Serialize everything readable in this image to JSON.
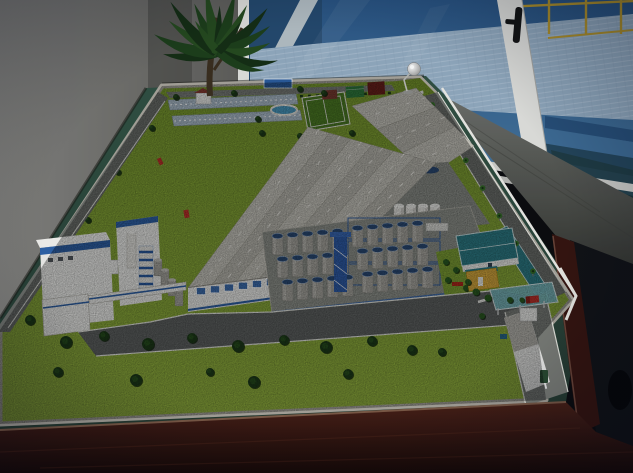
{
  "meta": {
    "kind": "photograph",
    "subject": "architectural scale model of an industrial plant displayed on a dark wooden table beside glass doors",
    "width": 633,
    "height": 473
  },
  "palette": {
    "wall_light": "#83827e",
    "wall_dark": "#5d5c58",
    "wall_shadow": "#44433f",
    "glass_blue_deep": "#24496e",
    "glass_blue": "#2a5584",
    "glass_blue_lt": "#49789f",
    "plate_floor": "#93abc0",
    "step_dark": "#27507a",
    "step_mid": "#3f6d97",
    "step_teal": "#24465c",
    "railing_yellow": "#b5952b",
    "frame_white": "#e3e3df",
    "handle_black": "#141414",
    "sill_white": "#cfcfcb",
    "sill_shade": "#b7b7b3",
    "glass_dark_teal": "#1e3a40",
    "concrete_lt": "#6e706b",
    "concrete_dk": "#23241f",
    "felt_lt": "#315143",
    "felt_dk": "#24382e",
    "wood_lt": "#4a2016",
    "wood_dk": "#170805",
    "wood_bevel": "#7d5a46",
    "wood_rim": "#35140e",
    "wood_rim_hl": "#6b4437",
    "dark_floor": "#101115",
    "site_rim": "#a8a49a",
    "lawn_near": "#93b13c",
    "lawn_far": "#7a9a2c",
    "lawn_dark": "#4d7c22",
    "slope_green": "#79982a",
    "garden_green": "#7fa032",
    "road": "#6d6f6a",
    "road_lt": "#7c7e78",
    "road_front": "#606260",
    "curb": "#e8e8e0",
    "yard": "#8b8d86",
    "platform": "#90928a",
    "roof_a": "#c9c6bc",
    "roof_b": "#bbb8ae",
    "ridge": "#e8e5dd",
    "eave": "#8e8b82",
    "roof_gray2": "#b8b5ad",
    "bldg_white": "#f1f0ec",
    "trim_blue": "#2f62a8",
    "window_blue": "#3f6fb0",
    "window_dark": "#555a5e",
    "tank_body": "#a9a69e",
    "tank_body_lt": "#c2bfb7",
    "tank_top": "#2b4a74",
    "scaffold_blue": "#2a5aa0",
    "silo_white": "#e9e7e1",
    "silo_shade": "#c9c7c0",
    "teal_roof": "#2e7d86",
    "teal_canopy": "#79b6ba",
    "yellow_bldg": "#d8a83a",
    "container_red": "#8e2b20",
    "container_red_dk": "#6f221a",
    "container_green": "#2f7a3a",
    "container_green_dk": "#1f5c2a",
    "container_blue": "#2a4f8e",
    "container_teal": "#1f6a5a",
    "container_maroon": "#6a1f18",
    "container_rust": "#7a3a2e",
    "tree_dark": "#1d3a16",
    "tree_green": "#2a5a20",
    "palm": "#3a7a2a",
    "truck_red": "#c03028",
    "truck_green": "#2a4a30",
    "bin_blue": "#2a6a8a",
    "bench_red": "#b02818",
    "pool_blue": "#4a9ac0",
    "billboard_blue": "#2a5a9a",
    "basin": "#aebecb",
    "hut_roof": "#8a3a30",
    "leaf_dark": "#152e14",
    "leaf_mid": "#1d3f1a",
    "leaf_lt": "#254a1e",
    "trunk": "#3a2e1e",
    "lamp_silver": "#d8d8d8"
  },
  "room": {
    "wall": {
      "label": "plain interior wall"
    },
    "plant": {
      "label": "potted foliage plant",
      "center": [
        218,
        52
      ],
      "leaves": [
        [
          -178,
          55,
          5,
          10,
          0
        ],
        [
          -160,
          68,
          6,
          14,
          1
        ],
        [
          -145,
          60,
          5,
          8,
          2
        ],
        [
          -130,
          74,
          6,
          16,
          0
        ],
        [
          -115,
          56,
          5,
          6,
          1
        ],
        [
          -100,
          70,
          6,
          12,
          2
        ],
        [
          -88,
          48,
          4,
          4,
          0
        ],
        [
          -75,
          66,
          6,
          10,
          1
        ],
        [
          -60,
          58,
          5,
          8,
          2
        ],
        [
          -45,
          70,
          6,
          14,
          0
        ],
        [
          -30,
          60,
          5,
          10,
          1
        ],
        [
          -15,
          54,
          5,
          12,
          2
        ],
        [
          2,
          60,
          5,
          16,
          0
        ],
        [
          15,
          48,
          4,
          14,
          1
        ],
        [
          -125,
          40,
          4,
          4,
          2
        ],
        [
          -55,
          40,
          4,
          6,
          0
        ]
      ]
    },
    "glass_wall": {
      "label": "aluminium framed glass doors",
      "railing_posts_x": [
        512,
        549,
        586,
        621
      ],
      "handle": {
        "label": "black door handle"
      }
    },
    "mezzanine": {
      "label": "blue industrial mezzanine floor with yellow railing seen through glass"
    },
    "floor": {
      "label": "grey concrete floor"
    }
  },
  "table": {
    "label": "dark mahogany display table",
    "surface": "green baize"
  },
  "model": {
    "base_rim": {
      "label": "light grey model base edge"
    },
    "factory_main": {
      "label": "main production halls",
      "roof_bands": 6,
      "facade_windows": 9,
      "corners": {
        "far_left": [
          308,
          127
        ],
        "far_right": [
          436,
          163
        ],
        "near_left": [
          188,
          288
        ],
        "near_right": [
          330,
          270
        ]
      }
    },
    "factory_rear": {
      "label": "rear hall block",
      "roof_bands": 3,
      "corners": {
        "far_left": [
          416,
          88
        ],
        "far_right": [
          474,
          146
        ],
        "near_left": [
          352,
          106
        ],
        "near_right": [
          428,
          176
        ]
      }
    },
    "tank_farm": {
      "label": "tank farm with blue-capped tanks",
      "grid1": {
        "origin": [
          272,
          236
        ],
        "cols": 5,
        "rows": 3
      },
      "grid2": {
        "origin": [
          352,
          228
        ],
        "cols": 5,
        "rows": 3
      }
    },
    "silos": {
      "label": "white silos",
      "count": 4,
      "x0": 394,
      "dx": 12,
      "y": 206,
      "w": 10,
      "h": 42
    },
    "containers": {
      "far": [
        "rust",
        "green",
        "maroon"
      ],
      "yard": [
        "red",
        "green",
        "blue",
        "teal"
      ]
    },
    "perimeter": {
      "palms_t": [
        0.06,
        0.2,
        0.34,
        0.48,
        0.62,
        0.76,
        0.9
      ],
      "road_a": [
        428,
        98
      ],
      "road_b": [
        548,
        296
      ]
    },
    "amenities": {
      "pool": "oval swimming pool",
      "sports_field": "football pitch",
      "billboard": "blue sign",
      "basins": "water treatment basins",
      "hut": "red roofed hut",
      "lettering": "white lettering on grass slope (illegible)"
    },
    "entrance": {
      "label": "gatehouse with teal glass canopy",
      "vehicles": [
        "red truck",
        "green truck"
      ]
    },
    "lamp": {
      "label": "miniature silver lamp at model corner"
    },
    "lawns": {
      "bushes": [
        [
          66,
          342,
          6
        ],
        [
          104,
          336,
          5
        ],
        [
          148,
          344,
          6
        ],
        [
          192,
          338,
          5
        ],
        [
          238,
          346,
          6
        ],
        [
          284,
          340,
          5
        ],
        [
          326,
          347,
          6
        ],
        [
          372,
          341,
          5
        ],
        [
          412,
          350,
          5
        ],
        [
          58,
          372,
          5
        ],
        [
          136,
          380,
          6
        ],
        [
          254,
          382,
          6
        ],
        [
          348,
          374,
          5
        ],
        [
          442,
          352,
          4
        ],
        [
          30,
          320,
          5
        ],
        [
          210,
          372,
          4
        ]
      ],
      "far_trees": [
        [
          176,
          97,
          3
        ],
        [
          234,
          93,
          3
        ],
        [
          258,
          119,
          3
        ],
        [
          300,
          89,
          3
        ],
        [
          324,
          93,
          3
        ],
        [
          330,
          137,
          3.5
        ],
        [
          352,
          133,
          3
        ],
        [
          406,
          129,
          3
        ],
        [
          300,
          136,
          3
        ],
        [
          262,
          133,
          3
        ],
        [
          152,
          128,
          3
        ],
        [
          118,
          172,
          3
        ],
        [
          88,
          220,
          3
        ]
      ],
      "gate_trees": [
        [
          476,
          292,
          3.5
        ],
        [
          488,
          298,
          3.5
        ],
        [
          510,
          300,
          3
        ],
        [
          482,
          316,
          3
        ],
        [
          468,
          282,
          3
        ],
        [
          522,
          300,
          2.5
        ]
      ],
      "garden_trees": [
        [
          446,
          262,
          3
        ],
        [
          456,
          270,
          3
        ],
        [
          448,
          280,
          3
        ],
        [
          466,
          288,
          3
        ],
        [
          492,
          292,
          3
        ]
      ]
    }
  }
}
